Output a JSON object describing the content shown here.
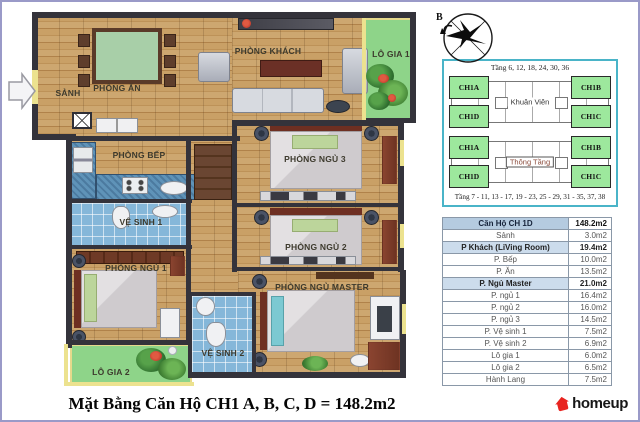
{
  "page": {
    "border_color": "#9a9ac8",
    "background": "#ffffff"
  },
  "compass": {
    "north_label": "B"
  },
  "floor_plan": {
    "rooms": [
      {
        "label": "SẢNH"
      },
      {
        "label": "PHÒNG ĂN"
      },
      {
        "label": "PHÒNG KHÁCH"
      },
      {
        "label": "LÔ GIA 1"
      },
      {
        "label": "PHÒNG BẾP"
      },
      {
        "label": "VỆ SINH 1"
      },
      {
        "label": "PHÒNG NGỦ 3"
      },
      {
        "label": "PHÒNG NGỦ 2"
      },
      {
        "label": "PHÒNG NGỦ 1"
      },
      {
        "label": "PHÒNG NGỦ MASTER"
      },
      {
        "label": "VỆ SINH 2"
      },
      {
        "label": "LÔ GIA 2"
      }
    ],
    "colors": {
      "wall": "#34333b",
      "wood_floor": "#c69c63",
      "balcony_green": "#8ed489",
      "bathroom_tile": "#85b7d9",
      "window_yellow": "#ece28f"
    }
  },
  "location_diagram": {
    "title_top": "Tầng 6, 12, 18, 24, 30, 36",
    "title_bottom": "Tầng 7 - 11, 13 - 17, 19 - 23, 25 - 29, 31 - 35, 37, 38",
    "unit_fill": "#9de89d",
    "border_color": "#4ab4c8",
    "floors": [
      {
        "center_label": "Khuân Viên",
        "units": {
          "top_left": "CH1A",
          "top_right": "CH1B",
          "bottom_left": "CH1D",
          "bottom_right": "CH1C"
        }
      },
      {
        "center_label": "Thông Tầng",
        "units": {
          "top_left": "CH1A",
          "top_right": "CH1B",
          "bottom_left": "CH1D",
          "bottom_right": "CH1C"
        }
      }
    ]
  },
  "area_table": {
    "rows": [
      {
        "name": "Căn Hộ CH 1D",
        "area": "148.2m2",
        "style": "header"
      },
      {
        "name": "Sảnh",
        "area": "3.0m2",
        "style": "normal"
      },
      {
        "name": "P Khách (LiVing Room)",
        "area": "19.4m2",
        "style": "section"
      },
      {
        "name": "P. Bếp",
        "area": "10.0m2",
        "style": "normal"
      },
      {
        "name": "P. Ăn",
        "area": "13.5m2",
        "style": "normal"
      },
      {
        "name": "P. Ngủ Master",
        "area": "21.0m2",
        "style": "section"
      },
      {
        "name": "P. ngủ 1",
        "area": "16.4m2",
        "style": "normal"
      },
      {
        "name": "P. ngủ 2",
        "area": "16.0m2",
        "style": "normal"
      },
      {
        "name": "P. ngủ 3",
        "area": "14.5m2",
        "style": "normal"
      },
      {
        "name": "P. Vệ sinh 1",
        "area": "7.5m2",
        "style": "normal"
      },
      {
        "name": "P. Vệ sinh 2",
        "area": "6.9m2",
        "style": "normal"
      },
      {
        "name": "Lô gia 1",
        "area": "6.0m2",
        "style": "normal"
      },
      {
        "name": "Lô gia 2",
        "area": "6.5m2",
        "style": "normal"
      },
      {
        "name": "Hành Lang",
        "area": "7.5m2",
        "style": "normal"
      }
    ]
  },
  "footer": {
    "title": "Mặt Bằng Căn Hộ CH1 A, B, C, D = 148.2m2",
    "logo_text": "homeup",
    "logo_color": "#e8231f"
  }
}
